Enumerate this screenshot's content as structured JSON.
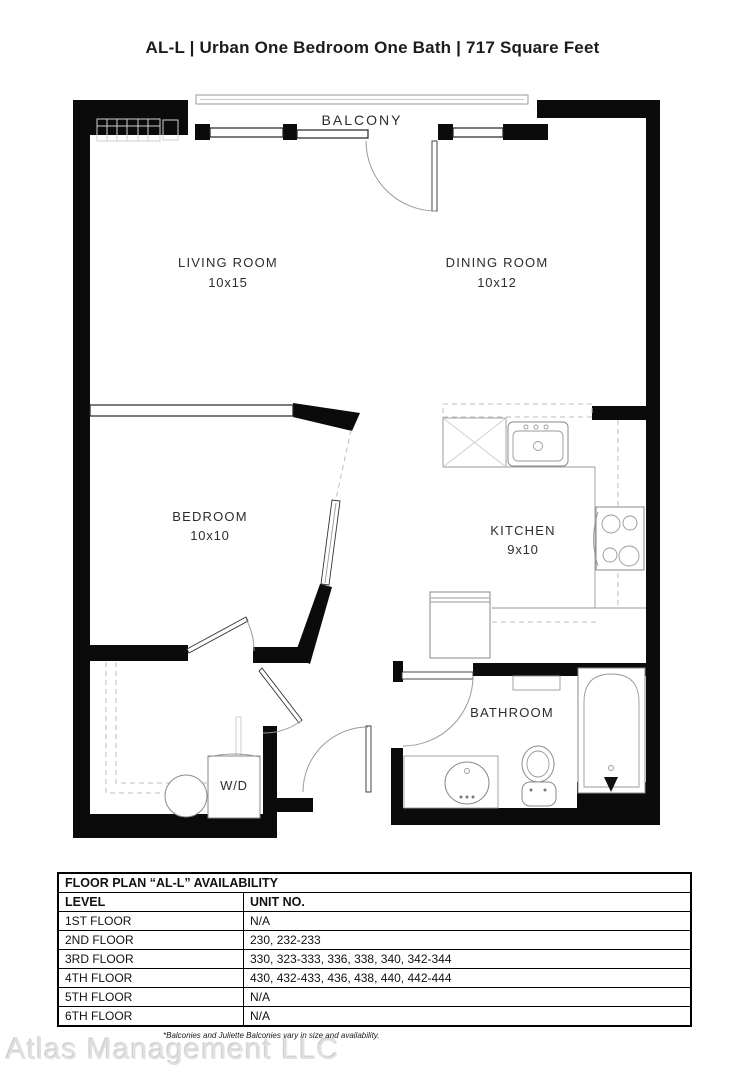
{
  "title": "AL-L | Urban One Bedroom One Bath | 717  Square Feet",
  "floorplan": {
    "rooms": {
      "balcony": {
        "label": "BALCONY"
      },
      "living": {
        "label": "LIVING ROOM",
        "dims": "10x15"
      },
      "dining": {
        "label": "DINING ROOM",
        "dims": "10x12"
      },
      "bedroom": {
        "label": "BEDROOM",
        "dims": "10x10"
      },
      "kitchen": {
        "label": "KITCHEN",
        "dims": "9x10"
      },
      "bathroom": {
        "label": "BATHROOM"
      },
      "laundry": {
        "label": "W/D"
      }
    }
  },
  "availability_table": {
    "title": "FLOOR PLAN “AL-L” AVAILABILITY",
    "columns": [
      "LEVEL",
      "UNIT NO."
    ],
    "rows": [
      {
        "level": "1ST FLOOR",
        "units": "N/A"
      },
      {
        "level": "2ND FLOOR",
        "units": "230, 232-233"
      },
      {
        "level": "3RD FLOOR",
        "units": "330, 323-333, 336, 338, 340, 342-344"
      },
      {
        "level": "4TH FLOOR",
        "units": "430, 432-433, 436, 438, 440, 442-444"
      },
      {
        "level": "5TH FLOOR",
        "units": "N/A"
      },
      {
        "level": "6TH FLOOR",
        "units": "N/A"
      }
    ]
  },
  "footnote": "*Balconies and Juliette Balconies vary in size and availability.",
  "watermark": "Atlas Management LLC",
  "colors": {
    "wall": "#0b0b0b",
    "line": "#9a9a9a",
    "text": "#2d2d2d"
  }
}
